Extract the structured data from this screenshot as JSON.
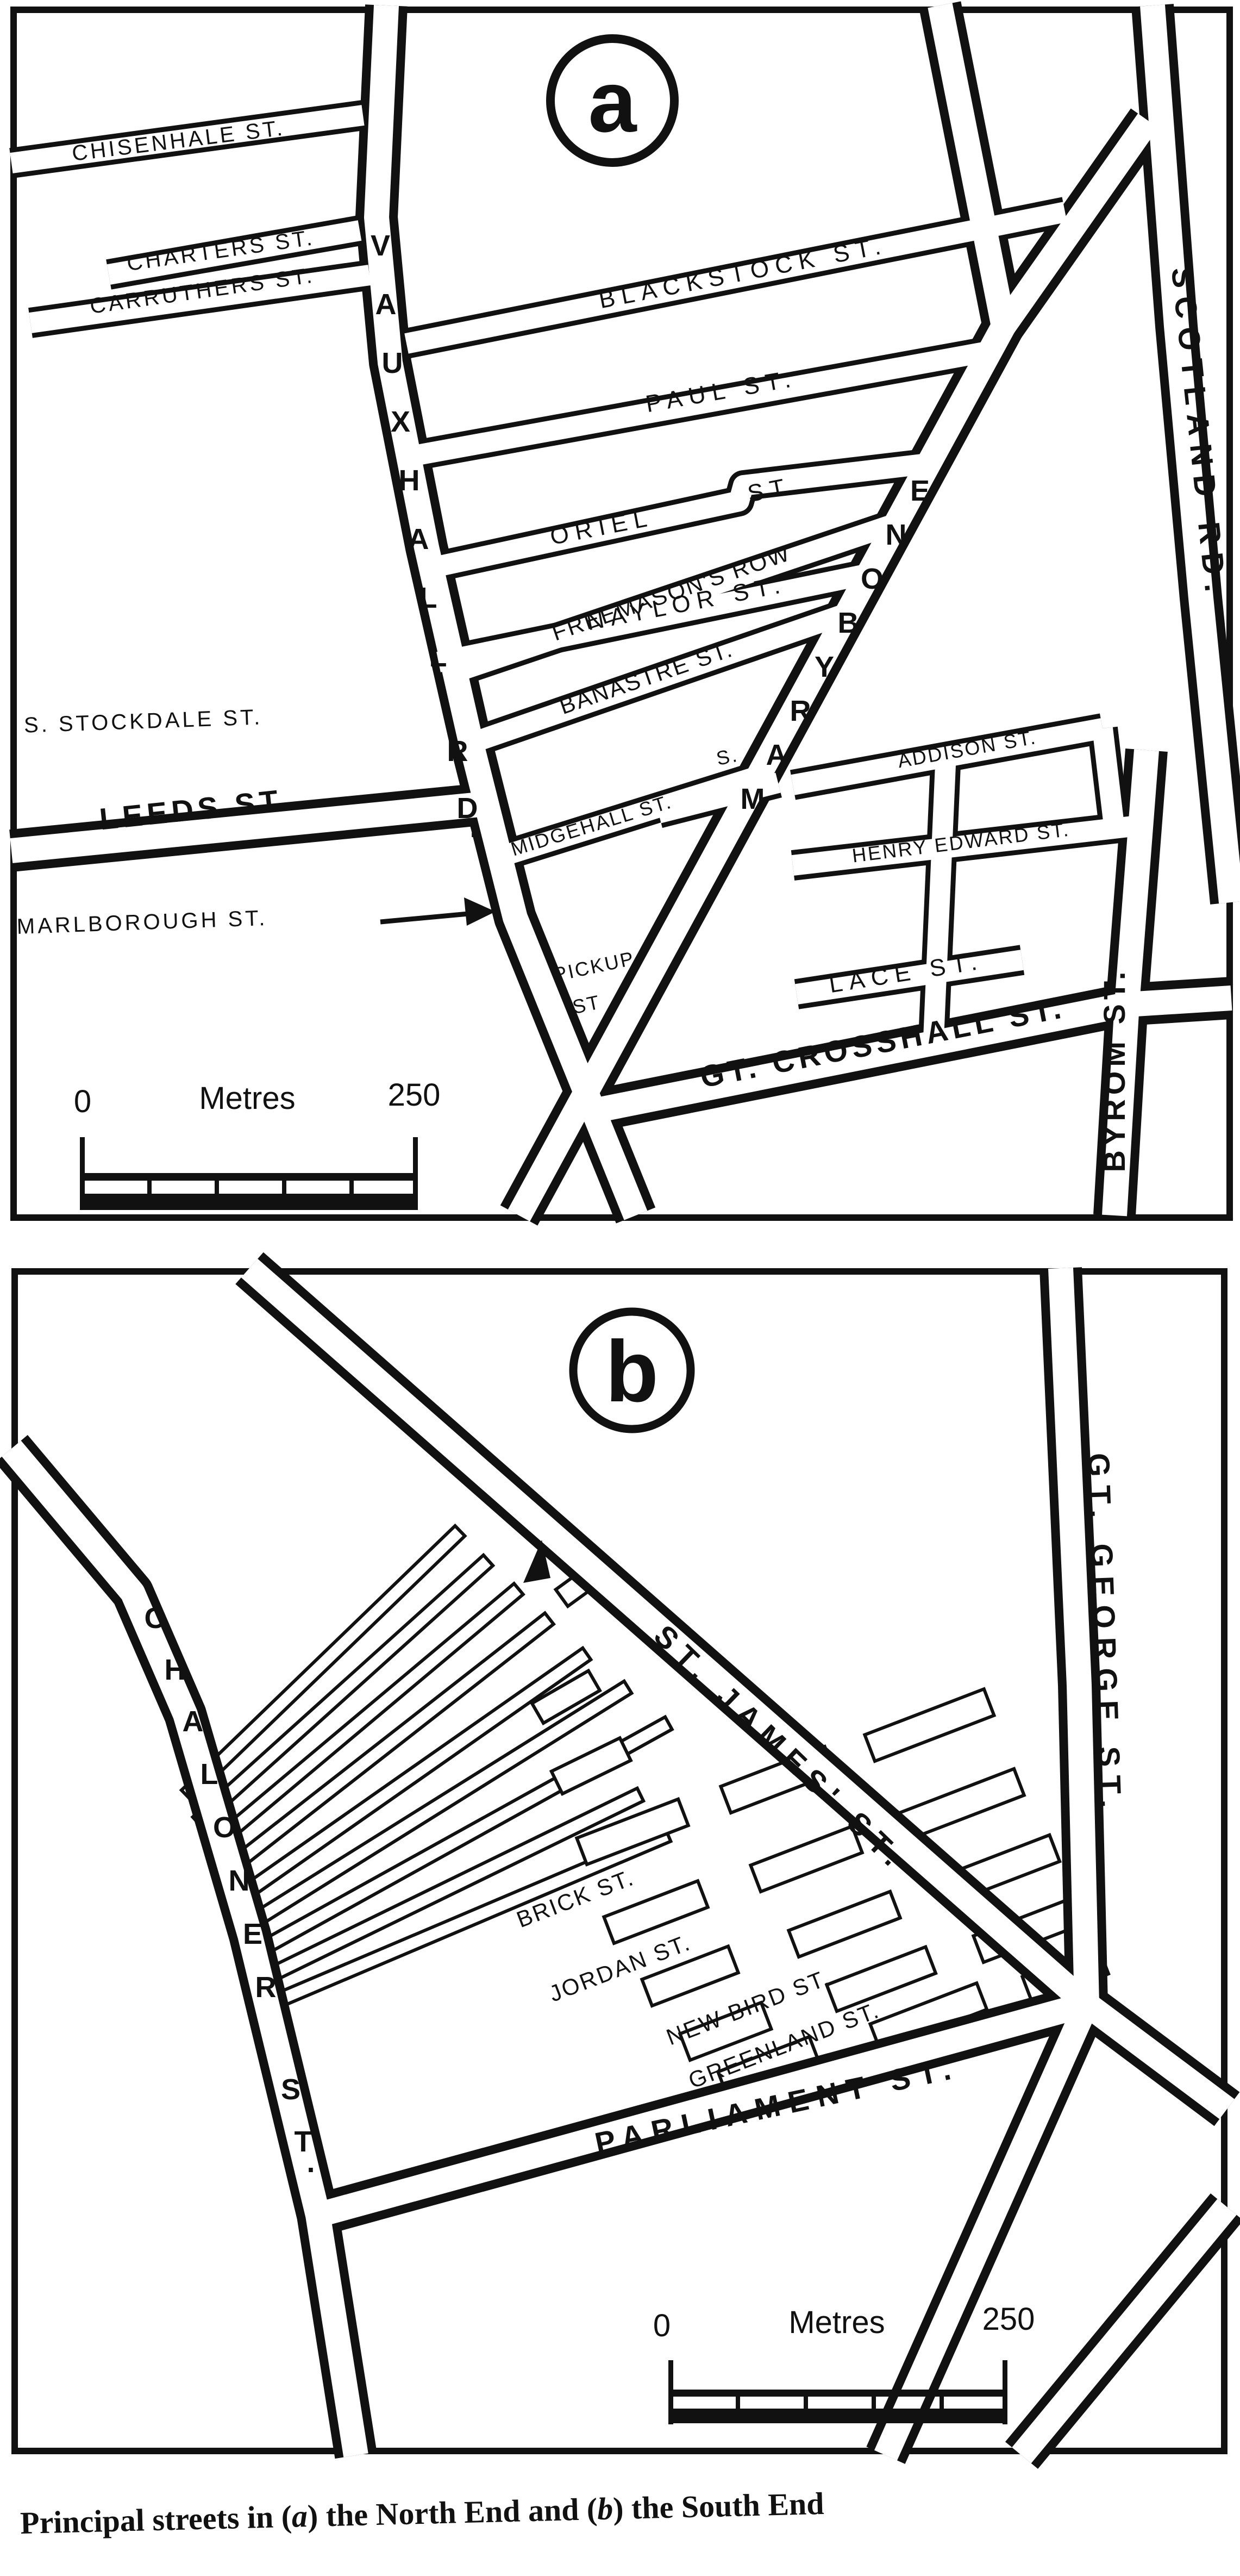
{
  "caption": {
    "part1": "Principal streets in (",
    "italic1": "a",
    "part2": ") the North End and (",
    "italic2": "b",
    "part3": ") the South End"
  },
  "map_a": {
    "badge": "a",
    "scale": {
      "zero": "0",
      "unit": "Metres",
      "value": "250"
    },
    "streets": {
      "chisenhale": "CHISENHALE ST.",
      "charters": "CHARTERS ST.",
      "carruthers": "CARRUTHERS ST.",
      "blackstock": "BLACKSTOCK ST.",
      "paul": "PAUL ST.",
      "oriel_1": "ORIEL",
      "oriel_2": "ST.",
      "naylor": "NAYLOR ST.",
      "freemasons": "FREEMASON'S ROW",
      "banastre": "BANASTRE ST.",
      "s_abbrev": "S.",
      "midgehall": "MIDGEHALL ST.",
      "addison": "ADDISON ST.",
      "henry_edward": "HENRY EDWARD ST.",
      "lace": "LACE ST.",
      "stockdale": "S. STOCKDALE ST.",
      "leeds": "LEEDS ST.",
      "marlborough": "MARLBOROUGH ST.",
      "pickup_1": "PICKUP",
      "pickup_2": "ST",
      "crosshall": "GT. CROSSHALL ST.",
      "vauxhall": "VAUXHALL RD.",
      "marybone": "MARYBONE",
      "scotland": "SCOTLAND RD.",
      "byrom": "BYROM ST."
    }
  },
  "map_b": {
    "badge": "b",
    "scale": {
      "zero": "0",
      "unit": "Metres",
      "value": "250"
    },
    "streets": {
      "st_james": "ST. JAMES' ST.",
      "gt_george": "GT. GEORGE ST.",
      "chaloner": "CHALONER ST.",
      "brick": "BRICK ST.",
      "jordan": "JORDAN ST.",
      "new_bird": "NEW BIRD ST.",
      "greenland": "GREENLAND ST.",
      "parliament": "PARLIAMENT ST."
    }
  }
}
